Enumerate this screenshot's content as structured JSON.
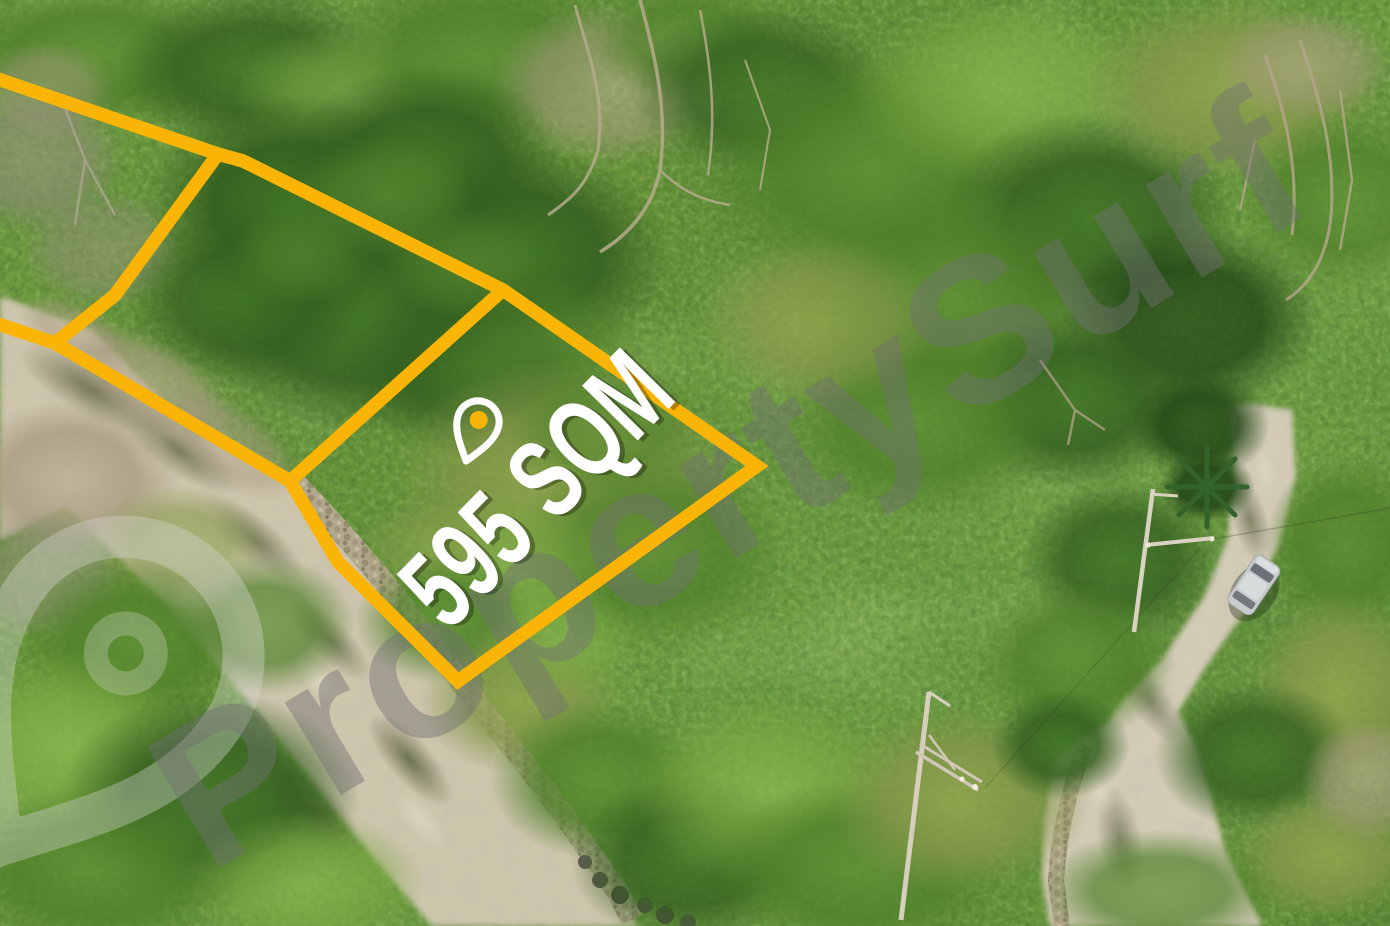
{
  "scene": {
    "type": "aerial-drone-photo",
    "subject": "vacant residential lot for sale, surrounded by trees and concrete roads"
  },
  "overlay": {
    "lot_area_label": "595 SQM"
  },
  "watermark": {
    "text": "PropertySurf"
  },
  "icons": {
    "location_pin": "location-pin-icon",
    "watermark_logo": "map-pin-logo-icon"
  },
  "colors": {
    "boundary_yellow": "#F9B406",
    "pin_dot_yellow": "#F6B504",
    "pin_outline_white": "#FFFFFF",
    "label_white": "#FFFFFF",
    "label_shadow": "rgba(0,0,0,0.30)",
    "watermark_text_gray": "rgba(112,112,112,0.45)",
    "watermark_logo_gray": "rgba(214,214,209,0.38)",
    "road_concrete_tan": "#CEC5AD",
    "road_concrete_tan_right": "#D3CBB6",
    "foliage_green_base": "#6F9D40"
  }
}
